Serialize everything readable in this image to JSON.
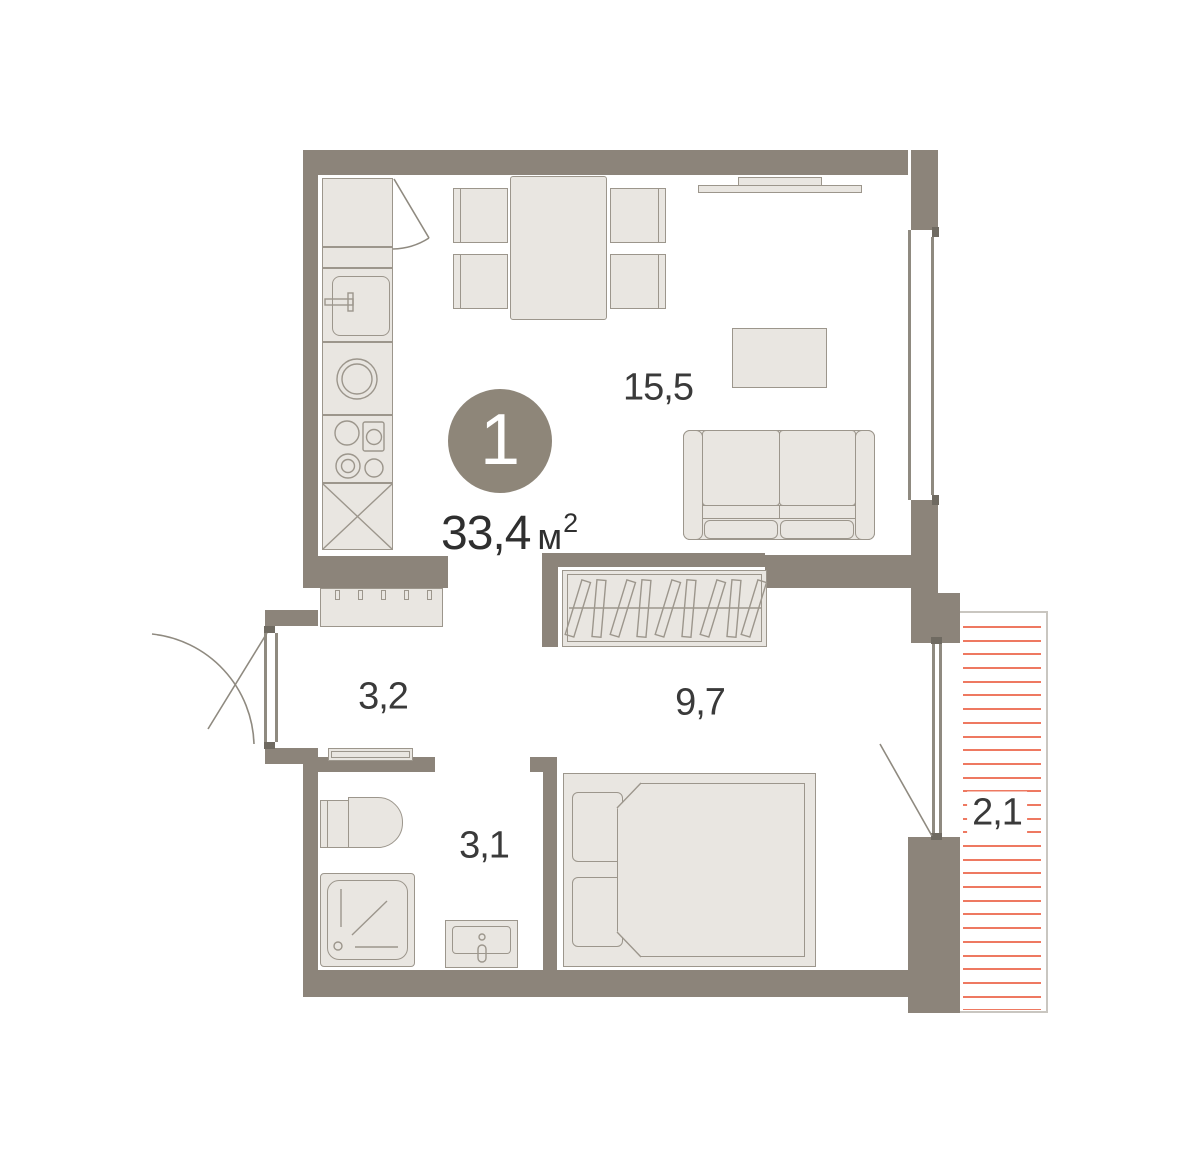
{
  "badge": {
    "number": "1"
  },
  "area": {
    "value": "33,4",
    "unit": "м",
    "superscript": "2"
  },
  "rooms": {
    "living": {
      "label": "15,5"
    },
    "hallway": {
      "label": "3,2"
    },
    "bedroom": {
      "label": "9,7"
    },
    "bathroom": {
      "label": "3,1"
    },
    "balcony": {
      "label": "2,1"
    }
  },
  "balcony": {
    "hatch_count": 29
  },
  "colors": {
    "wall": "#8c847a",
    "furn-fill": "#e9e6e1",
    "furn-stroke": "#9c968c",
    "line": "#8f8a80",
    "accent": "#ee7961",
    "badge": "#8e8679",
    "text": "#3a3a3a",
    "frame": "#c9c6c0"
  }
}
